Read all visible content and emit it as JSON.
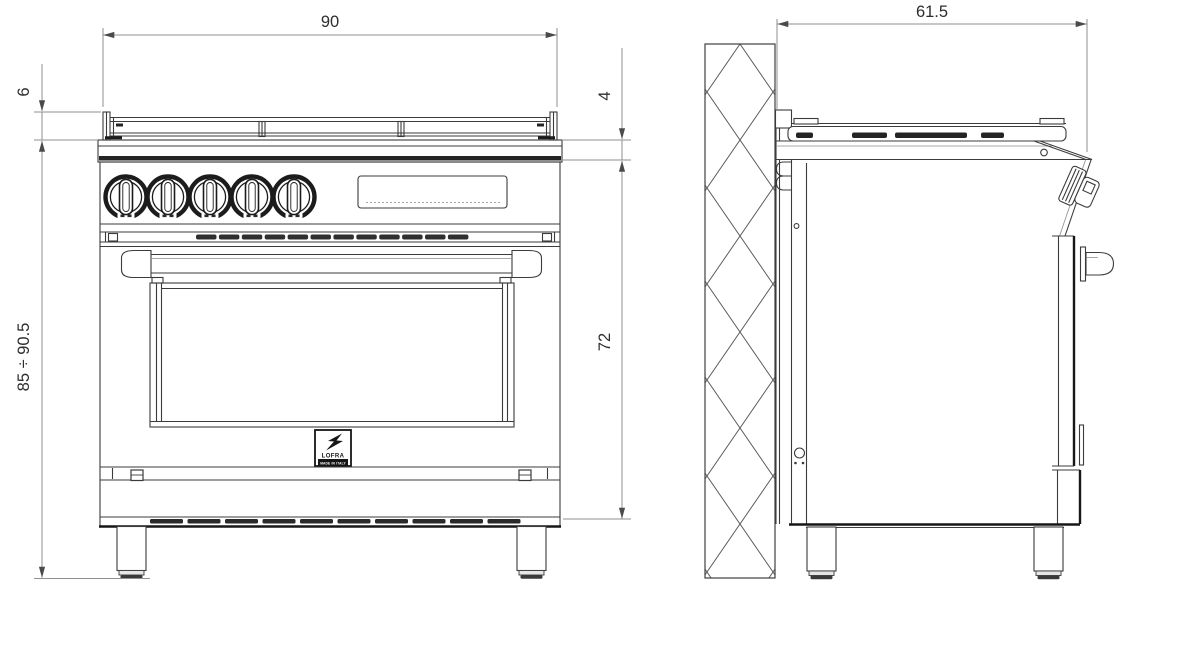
{
  "dimensions": {
    "width": "90",
    "grate_height": "6",
    "overall_height_range": "85 ÷ 90.5",
    "top_trim_height": "4",
    "body_height": "72",
    "depth": "61.5"
  },
  "logo": {
    "brand": "LOFRA",
    "origin_label": "MADE IN ITALY"
  },
  "colors": {
    "background": "#ffffff",
    "line": "#3b3b3b",
    "heavy_line": "#171717",
    "dimension_line": "#8f8f8f",
    "dimension_text": "#2d2d2d"
  }
}
